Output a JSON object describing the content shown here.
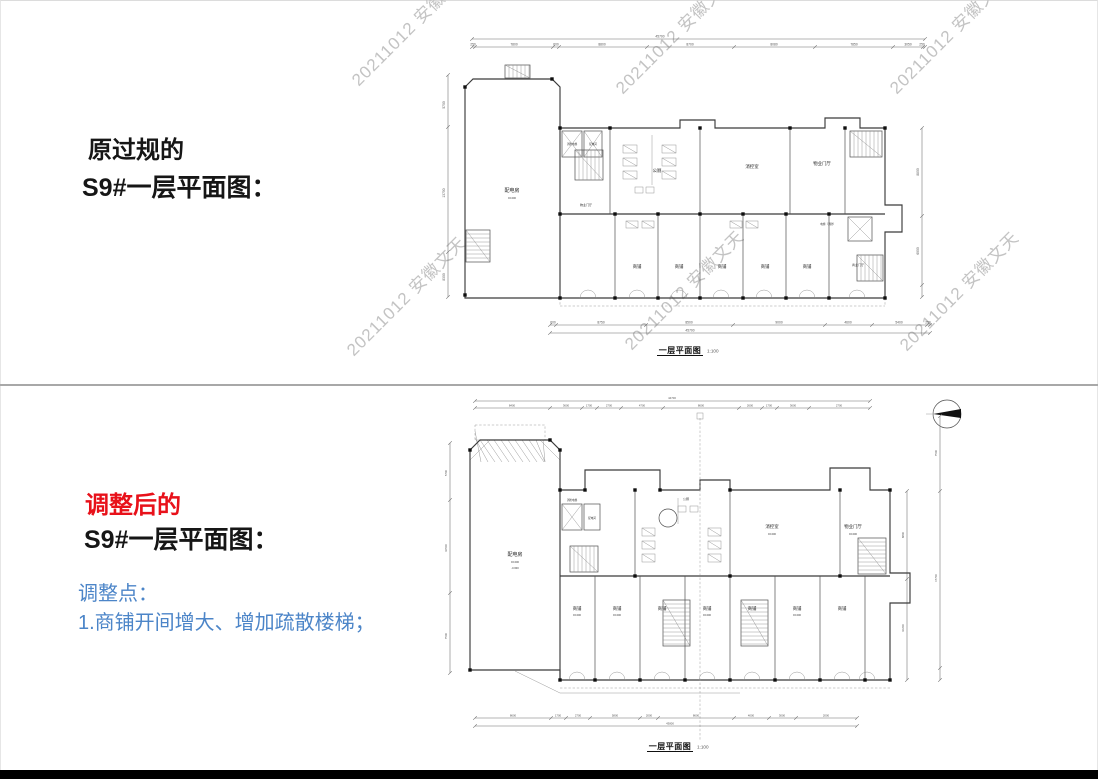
{
  "colors": {
    "accent_red": "#e8111a",
    "accent_blue": "#4c85c8",
    "divider": "#a8a8a8",
    "watermark": "#c3c3c3",
    "footer_bar": "#000000"
  },
  "watermark": {
    "text": "20211012 安徽文天"
  },
  "top_section": {
    "heading_line1": "原过规的",
    "heading_line2": "S9#一层平面图："
  },
  "bottom_section": {
    "heading_line1": "调整后的",
    "heading_line2": "S9#一层平面图：",
    "notes_title": "调整点：",
    "note_1": "1.商铺开间增大、增加疏散楼梯；"
  },
  "top_plan": {
    "caption": "一层平面图",
    "caption_scale": "1:100",
    "total_top": "45700",
    "total_bottom": "45700",
    "top_dims": [
      "250",
      "7800",
      "600",
      "8800",
      "8700",
      "8080",
      "7850",
      "3050",
      "250"
    ],
    "bottom_dims": [
      "600",
      "8750",
      "8500",
      "9000",
      "4600",
      "5400",
      "250"
    ],
    "left_dims": [
      "5700",
      "13700",
      "8300"
    ],
    "right_dims": [
      "8800",
      "6900"
    ],
    "rooms": {
      "power_room": "配电房",
      "fire_elevator": "消防电梯",
      "power_dist": "配电间",
      "public_wc": "公厕",
      "fire_control": "消控室",
      "property_lobby": "物业门厅",
      "shop": "商铺",
      "elevator_fire": "电梯（消防）",
      "commercial_lobby": "商业门厅",
      "elev_zero": "±0.000"
    }
  },
  "bottom_plan": {
    "caption": "一层平面图",
    "caption_scale": "1:100",
    "total_top": "44700",
    "total_bottom": "43800",
    "top_dims": [
      "8400",
      "3600",
      "1700",
      "2700",
      "4700",
      "8600",
      "2600",
      "1700",
      "3600",
      "2700"
    ],
    "bottom_dims": [
      "8600",
      "1700",
      "2700",
      "5800",
      "2000",
      "8600",
      "4000",
      "3000",
      "2000"
    ],
    "left_dims": [
      "5700",
      "10500",
      "7500"
    ],
    "right_dims": [
      "8800",
      "10200"
    ],
    "far_right_dims": [
      "7500",
      "17700"
    ],
    "rooms": {
      "power_room": "配电房",
      "fire_elevator": "消防电梯",
      "power_dist": "配电间",
      "public_wc": "公厕",
      "fire_control": "消控室",
      "property_lobby": "物业门厅",
      "shop": "商铺",
      "elev_zero": "±0.000",
      "elev_pit": "-0.600"
    }
  }
}
